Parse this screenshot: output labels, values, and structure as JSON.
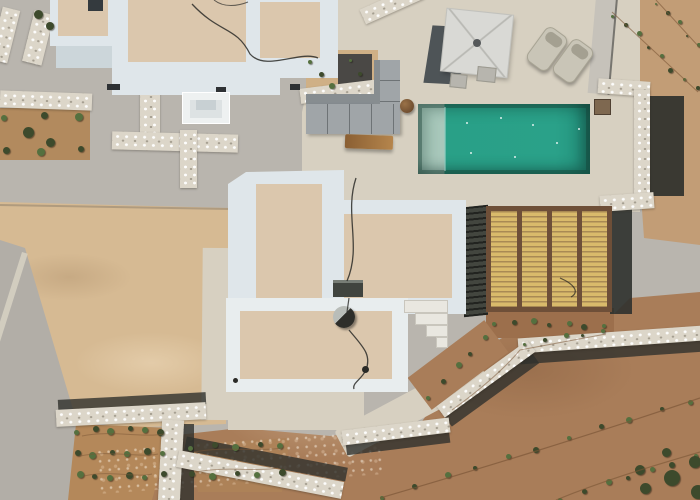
{
  "scene": {
    "description": "Aerial drone view of a white Cycladic-style villa complex with a teal swimming pool, pebbled sun deck, patio umbrella, sun loungers, outdoor sofa, bamboo pergola, stone retaining walls and graded dirt terraces planted with seedling rows",
    "objects": {
      "photo": "Aerial photo of villa with pool",
      "pool": "Swimming pool",
      "pool_equipment": "Pool equipment box",
      "umbrella": "Patio umbrella",
      "loungers": "Sun lounger",
      "sofa": "Outdoor corner sofa",
      "bench": "Wooden bench",
      "pergola": "Bamboo pergola roof",
      "villa_main": "Main villa rooftop",
      "villa_upper": "Upper villa rooftop",
      "villa_left": "Neighbouring villa rooftop",
      "villa_lower": "Lower villa rooftop",
      "satellite_dish": "Satellite dish",
      "ac_unit": "Rooftop AC unit",
      "stairs": "Terrace steps",
      "stone_wall": "Dry stone retaining wall",
      "garden": "Planted garden terrace",
      "dirt": "Graded earth with seedling rows",
      "sand": "Sandy plot",
      "road": "Concrete driveway",
      "deck": "Pebbled pool deck"
    },
    "palette": {
      "concrete": "#b9b5ae",
      "concrete_light": "#c6c2ba",
      "deck": "#d7d0c1",
      "stone": "#dcd6c9",
      "roof": "#dbc7ad",
      "parapet": "#dfe6ea",
      "parapet_bright": "#e8edee",
      "sand": "#d6ba93",
      "dirt_light": "#c29d76",
      "dirt": "#a97d59",
      "road": "#b2aea7",
      "shadow": "#2f312d",
      "pool": "#2aa189",
      "pool_steps": "#a8c8bb",
      "bamboo": "#d9ba6b",
      "wood": "#6e4f38",
      "bench": "#b5854c",
      "sofa": "#a0a5a8",
      "sofa_dark": "#878d90",
      "lounger": "#c9c5b7",
      "umbrella": "#d9d9d5",
      "umb_shadow": "#474d51",
      "plant": "#55703f",
      "plant_dark": "#3d4a2c",
      "equip": "#7e6850",
      "cable": "#2b2b28",
      "drip": "#7a5536"
    },
    "pool_sparkles": [
      [
        466,
        122
      ],
      [
        500,
        117
      ],
      [
        532,
        124
      ],
      [
        470,
        152
      ],
      [
        514,
        156
      ],
      [
        556,
        142
      ],
      [
        578,
        128
      ]
    ],
    "vegetation": {
      "rows": [
        {
          "x1": 614,
          "y1": 14,
          "x2": 696,
          "y2": 90,
          "n": 8,
          "s": 4
        },
        {
          "x1": 658,
          "y1": 2,
          "x2": 698,
          "y2": 46,
          "n": 5,
          "s": 3.5
        },
        {
          "x1": 384,
          "y1": 496,
          "x2": 692,
          "y2": 400,
          "n": 11,
          "s": 5
        },
        {
          "x1": 562,
          "y1": 498,
          "x2": 696,
          "y2": 456,
          "n": 7,
          "s": 5
        },
        {
          "x1": 526,
          "y1": 342,
          "x2": 602,
          "y2": 332,
          "n": 5,
          "s": 4
        },
        {
          "x1": 312,
          "y1": 60,
          "x2": 330,
          "y2": 88,
          "n": 3,
          "s": 5
        },
        {
          "x1": 352,
          "y1": 58,
          "x2": 360,
          "y2": 74,
          "n": 2,
          "s": 4
        },
        {
          "x1": 496,
          "y1": 322,
          "x2": 604,
          "y2": 326,
          "n": 7,
          "s": 5
        },
        {
          "x1": 430,
          "y1": 396,
          "x2": 484,
          "y2": 338,
          "n": 5,
          "s": 5
        }
      ],
      "patches": [
        {
          "x": 6,
          "y": 116,
          "w": 74,
          "h": 34,
          "rows": 2,
          "cols": 3,
          "s": 7
        },
        {
          "x": 78,
          "y": 430,
          "w": 84,
          "h": 46,
          "rows": 3,
          "cols": 6,
          "s": 6
        },
        {
          "x": 192,
          "y": 446,
          "w": 88,
          "h": 28,
          "rows": 2,
          "cols": 5,
          "s": 6
        }
      ],
      "bushes": [
        [
          38,
          14,
          9
        ],
        [
          50,
          26,
          8
        ],
        [
          28,
          132,
          11
        ],
        [
          50,
          142,
          9
        ],
        [
          672,
          478,
          16
        ],
        [
          695,
          462,
          12
        ],
        [
          645,
          488,
          11
        ],
        [
          698,
          492,
          14
        ],
        [
          640,
          470,
          10
        ],
        [
          666,
          452,
          9
        ]
      ]
    },
    "svg_paths": [
      {
        "d": "M192,4 C220,34 236,26 250,54 C266,72 300,50 318,58",
        "c": "cable",
        "w": 1.3,
        "o": 0.85
      },
      {
        "d": "M214,0 C224,8 238,6 248,2",
        "c": "cable",
        "w": 1,
        "o": 0.7
      },
      {
        "d": "M356,178 C344,214 362,246 347,281",
        "c": "cable",
        "w": 1.3,
        "o": 0.85
      },
      {
        "d": "M349,298 L347,312",
        "c": "cable",
        "w": 1.2,
        "o": 0.8
      },
      {
        "d": "M349,330 C362,346 372,354 366,370 C361,380 352,383 354,389",
        "c": "cable",
        "w": 1.3,
        "o": 0.85
      },
      {
        "d": "M612,12 L698,92",
        "c": "drip",
        "w": 1,
        "o": 0.6
      },
      {
        "d": "M656,0 L700,48",
        "c": "drip",
        "w": 1,
        "o": 0.6
      },
      {
        "d": "M380,498 C470,472 600,432 700,398",
        "c": "drip",
        "w": 1.2,
        "o": 0.65
      },
      {
        "d": "M556,500 C610,478 660,464 700,452",
        "c": "drip",
        "w": 1.2,
        "o": 0.6
      },
      {
        "d": "M452,410 C480,390 505,368 520,350 L606,334",
        "c": "drip",
        "w": 1,
        "o": 0.55
      },
      {
        "d": "M82,436 C112,430 142,438 164,434",
        "c": "drip",
        "w": 1,
        "o": 0.5
      },
      {
        "d": "M80,456 C110,450 140,458 158,454",
        "c": "drip",
        "w": 1,
        "o": 0.5
      },
      {
        "d": "M84,476 C110,470 136,478 152,474",
        "c": "drip",
        "w": 1,
        "o": 0.5
      },
      {
        "d": "M194,452 C224,446 256,452 282,448",
        "c": "drip",
        "w": 1,
        "o": 0.5
      },
      {
        "d": "M196,472 C226,466 254,472 278,468",
        "c": "drip",
        "w": 1,
        "o": 0.5
      },
      {
        "d": "M560,278 C574,284 580,292 571,297",
        "c": "dark",
        "w": 1.2,
        "o": 0.7
      }
    ]
  }
}
